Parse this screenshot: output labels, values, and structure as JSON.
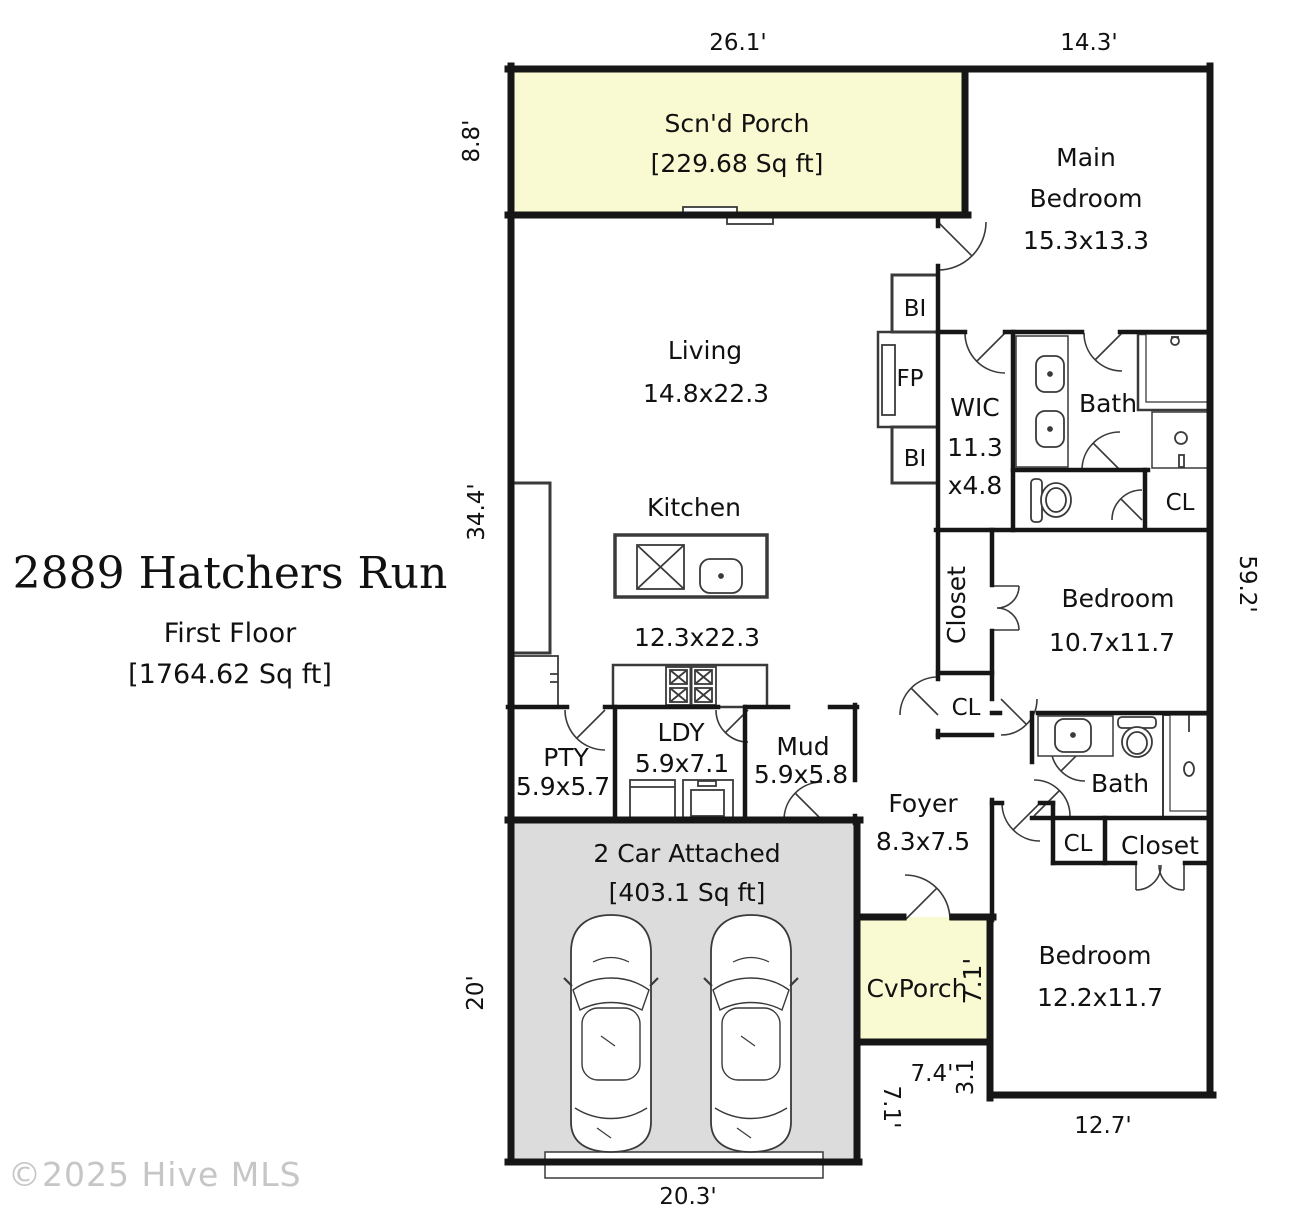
{
  "title": {
    "address": "2889 Hatchers Run",
    "floor": "First Floor",
    "area": "[1764.62 Sq ft]"
  },
  "watermark": "©2025 Hive MLS",
  "colors": {
    "porch_fill": "#FAFAD2",
    "garage_fill": "#DCDCDC",
    "wall": "#161616"
  },
  "rooms": {
    "scnd_porch": {
      "name": "Scn'd Porch",
      "area": "[229.68 Sq ft]"
    },
    "main_bedroom": {
      "name_line1": "Main",
      "name_line2": "Bedroom",
      "dims": "15.3x13.3"
    },
    "living": {
      "name": "Living",
      "dims": "14.8x22.3"
    },
    "kitchen": {
      "name": "Kitchen",
      "dims": "12.3x22.3"
    },
    "wic": {
      "name": "WIC",
      "dims_line1": "11.3",
      "dims_line2": "x4.8"
    },
    "bath_main": {
      "name": "Bath"
    },
    "cl_main": {
      "name": "CL"
    },
    "closet_1": {
      "name": "Closet"
    },
    "bedroom_1": {
      "name": "Bedroom",
      "dims": "10.7x11.7"
    },
    "cl_1": {
      "name": "CL"
    },
    "pty": {
      "name": "PTY",
      "dims": "5.9x5.7"
    },
    "ldy": {
      "name": "LDY",
      "dims": "5.9x7.1"
    },
    "mud": {
      "name": "Mud",
      "dims": "5.9x5.8"
    },
    "foyer": {
      "name": "Foyer",
      "dims": "8.3x7.5"
    },
    "bath_2": {
      "name": "Bath"
    },
    "cl_2": {
      "name": "CL"
    },
    "closet_2": {
      "name": "Closet"
    },
    "bedroom_2": {
      "name": "Bedroom",
      "dims": "12.2x11.7"
    },
    "garage": {
      "name": "2 Car Attached",
      "area": "[403.1 Sq ft]"
    },
    "cv_porch": {
      "name": "CvPorch",
      "depth": "7.1'"
    },
    "fireplace": {
      "name": "FP"
    },
    "built_in_1": {
      "name": "BI"
    },
    "built_in_2": {
      "name": "BI"
    }
  },
  "dimensions": {
    "porch_width": "26.1'",
    "main_bedroom_width": "14.3'",
    "porch_depth": "8.8'",
    "living_side": "34.4'",
    "right_side": "59.2'",
    "garage_depth": "20'",
    "garage_width": "20.3'",
    "nook_width": "7.4'",
    "nook_depth": "3.1",
    "garage_right_side": "7.1'",
    "bedroom_2_width": "12.7'"
  }
}
